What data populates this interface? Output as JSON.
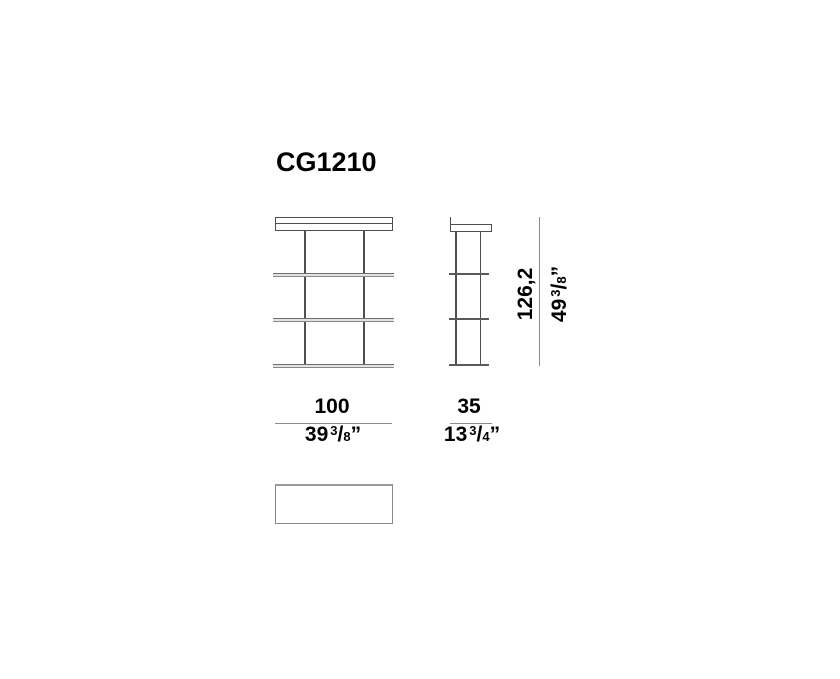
{
  "title": "CG1210",
  "structure": {
    "shelf_levels": 4,
    "posts_per_view": 2,
    "views_shown": [
      "front elevation",
      "side elevation",
      "top plan"
    ]
  },
  "dimensions": {
    "height": {
      "metric": "126,2",
      "imperial_whole": "49",
      "imperial_numerator": "3",
      "fraction_slash": "/",
      "imperial_denominator": "8",
      "inch_mark": "”"
    },
    "width": {
      "metric": "100",
      "imperial_whole": "39",
      "imperial_numerator": "3",
      "fraction_slash": "/",
      "imperial_denominator": "8",
      "inch_mark": "”"
    },
    "depth": {
      "metric": "35",
      "imperial_whole": "13",
      "imperial_numerator": "3",
      "fraction_slash": "/",
      "imperial_denominator": "4",
      "inch_mark": "”"
    }
  },
  "colors": {
    "background": "#ffffff",
    "text": "#000000",
    "structure_line": "#4f4f4f",
    "shelf_edge": "#6f6f6f",
    "shelf_fill": "#e2e2e2",
    "dimension_line": "#8c8c8c"
  }
}
